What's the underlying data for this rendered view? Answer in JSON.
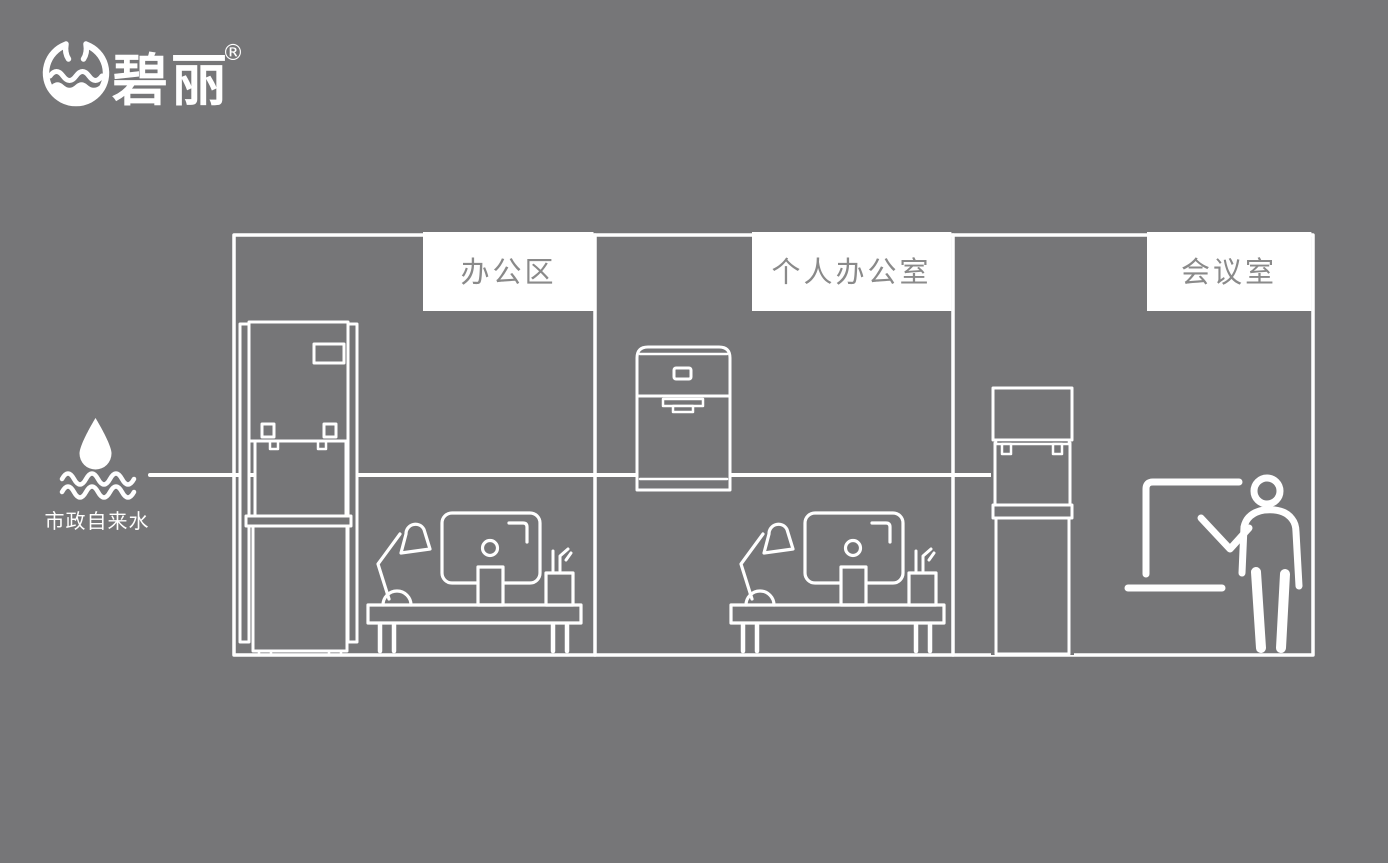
{
  "brand": {
    "name": "碧丽",
    "registered_mark": "®",
    "logo_icon": "water-cup-circle-icon"
  },
  "water_source": {
    "label": "市政自来水",
    "icons": [
      "water-drop-icon",
      "water-waves-icon"
    ]
  },
  "floor_plan": {
    "rooms": [
      {
        "label": "办公区",
        "icons": [
          "floor-standing-water-dispenser-icon",
          "desk-lamp-icon",
          "monitor-icon",
          "pen-cup-icon",
          "desk-icon"
        ]
      },
      {
        "label": "个人办公室",
        "icons": [
          "countertop-water-dispenser-icon",
          "desk-lamp-icon",
          "monitor-icon",
          "pen-cup-icon",
          "desk-icon"
        ]
      },
      {
        "label": "会议室",
        "icons": [
          "upright-water-dispenser-icon",
          "whiteboard-icon",
          "presenter-icon"
        ]
      }
    ],
    "connection": "water-pipe-line from municipal tap water to each room dispenser"
  },
  "colors": {
    "background": "#767678",
    "line": "#ffffff",
    "label_box_bg": "#ffffff",
    "label_text": "#8a8a8a"
  }
}
